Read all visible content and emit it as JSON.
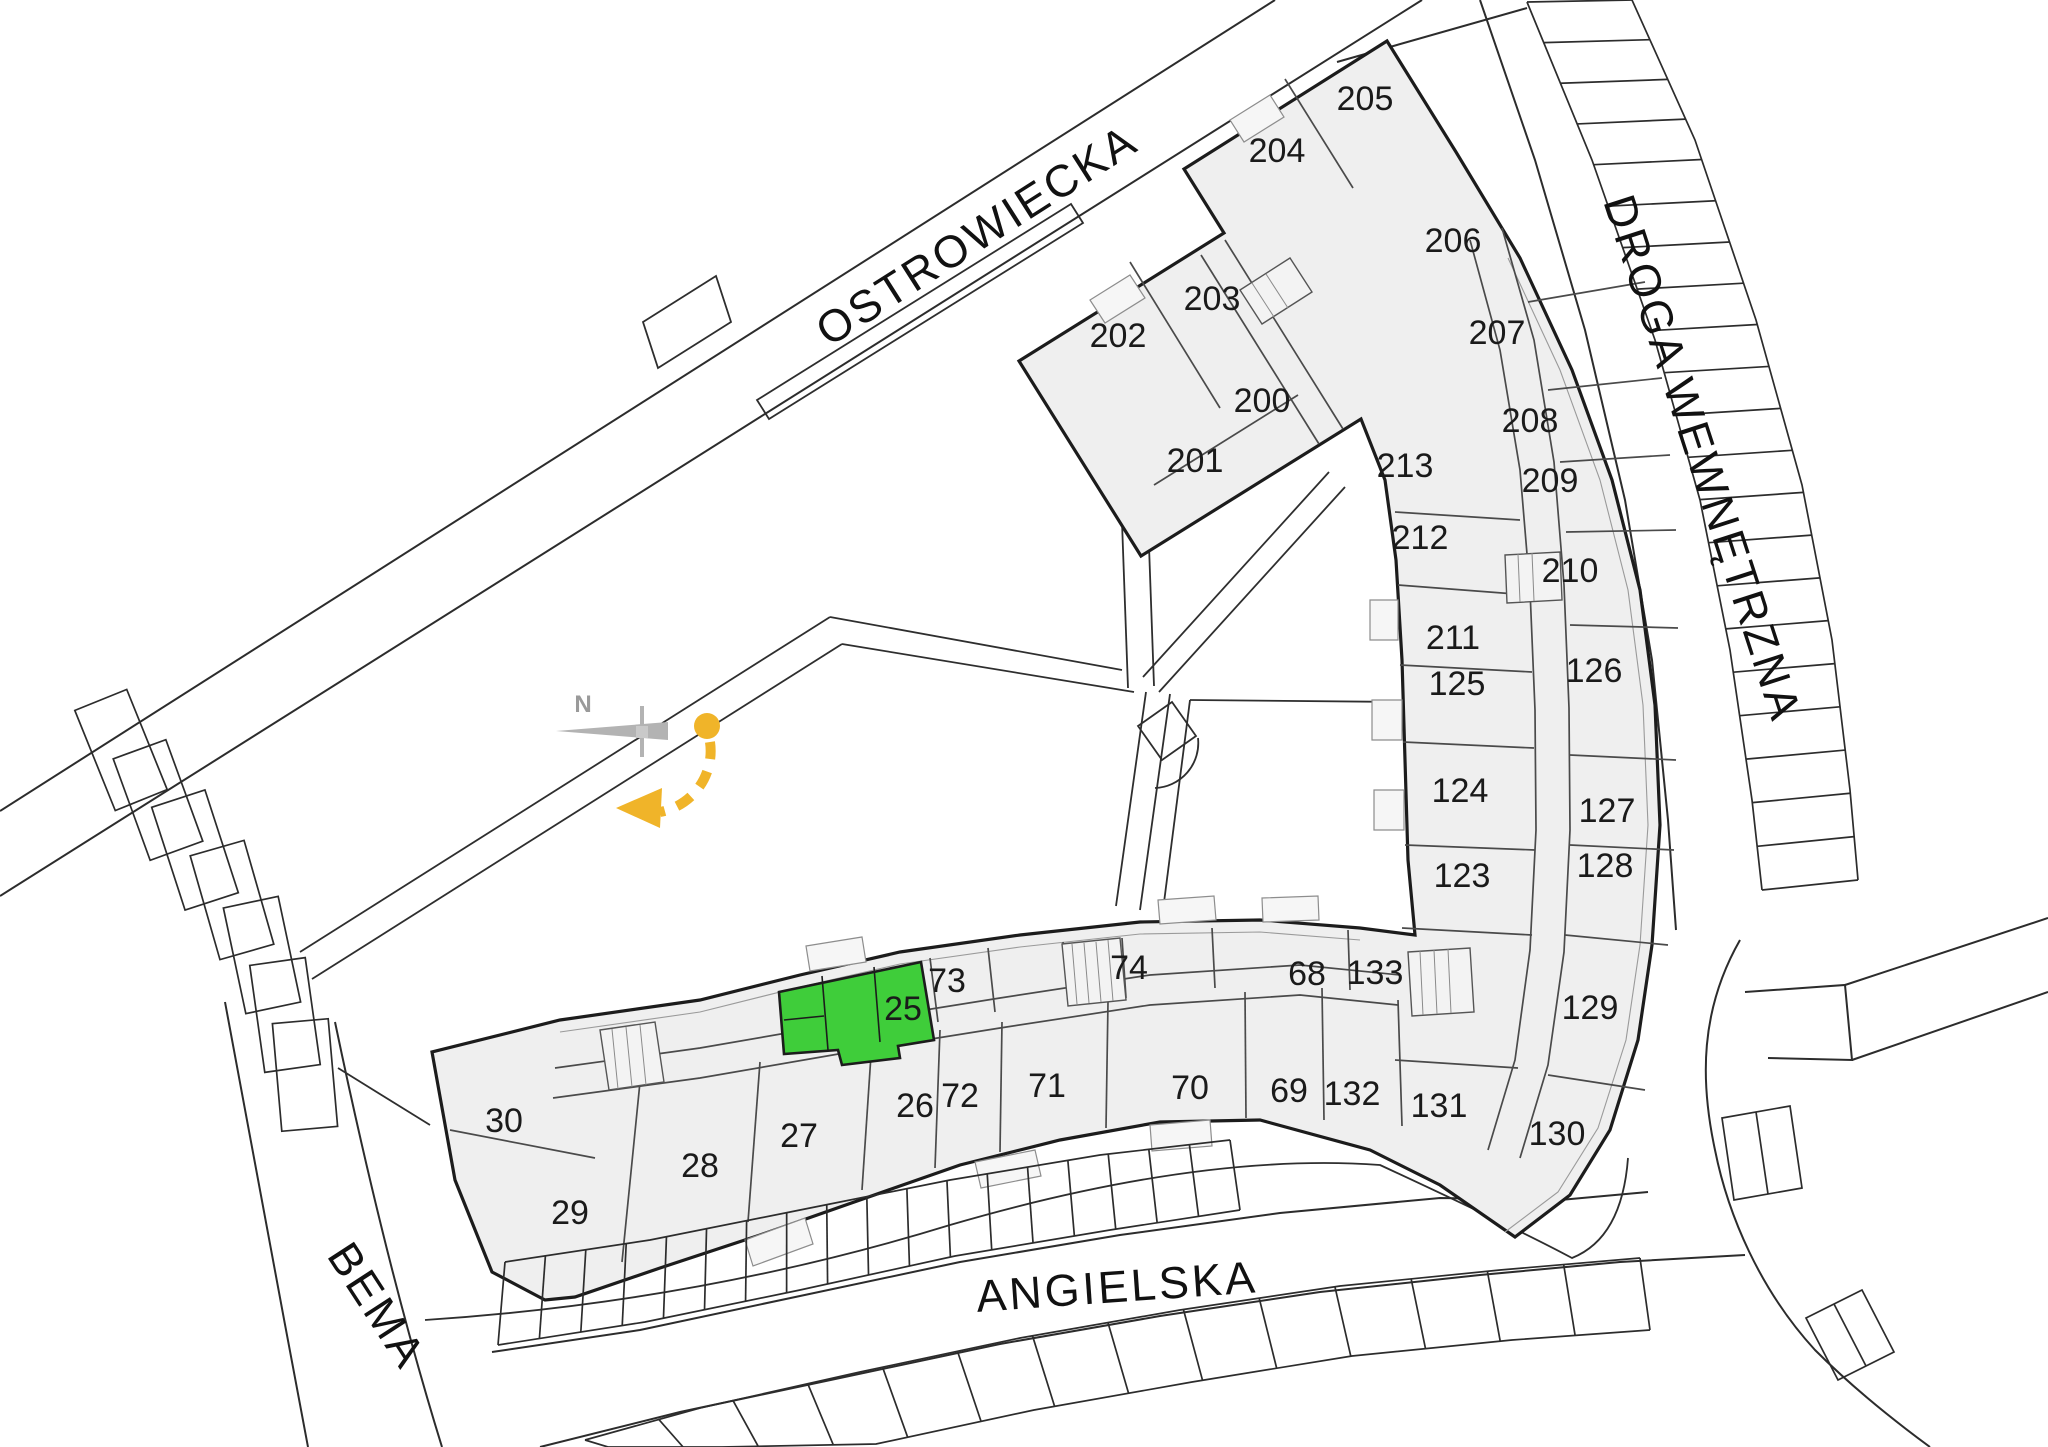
{
  "plan": {
    "compass": {
      "label": "N"
    },
    "colors": {
      "highlight_green": "#3fcd3a",
      "compass_yellow": "#f0b429",
      "building_fill": "#efefef",
      "line_dark": "#1c1c1c"
    },
    "selected_unit": {
      "label": "25",
      "x": 903,
      "y": 1020
    },
    "streets": [
      {
        "id": "ostrowiecka",
        "name": "OSTROWIECKA",
        "x": 985,
        "y": 248,
        "rotate": -32.5
      },
      {
        "id": "droga-wewnetrzna",
        "name": "DROGA WEWNĘTRZNA",
        "x": 1688,
        "y": 463,
        "rotate": 72
      },
      {
        "id": "bema",
        "name": "BEMA",
        "x": 364,
        "y": 1314,
        "rotate": 57
      },
      {
        "id": "angielska",
        "name": "ANGIELSKA",
        "x": 1118,
        "y": 1302,
        "rotate": -4
      }
    ],
    "units": [
      {
        "label": "200",
        "x": 1262,
        "y": 412
      },
      {
        "label": "201",
        "x": 1195,
        "y": 472
      },
      {
        "label": "202",
        "x": 1118,
        "y": 347
      },
      {
        "label": "203",
        "x": 1212,
        "y": 310
      },
      {
        "label": "204",
        "x": 1277,
        "y": 162
      },
      {
        "label": "205",
        "x": 1365,
        "y": 110
      },
      {
        "label": "206",
        "x": 1453,
        "y": 252
      },
      {
        "label": "207",
        "x": 1497,
        "y": 344
      },
      {
        "label": "208",
        "x": 1530,
        "y": 432
      },
      {
        "label": "209",
        "x": 1550,
        "y": 492
      },
      {
        "label": "210",
        "x": 1570,
        "y": 582
      },
      {
        "label": "211",
        "x": 1453,
        "y": 649
      },
      {
        "label": "212",
        "x": 1420,
        "y": 549
      },
      {
        "label": "213",
        "x": 1405,
        "y": 477
      },
      {
        "label": "123",
        "x": 1462,
        "y": 887
      },
      {
        "label": "124",
        "x": 1460,
        "y": 802
      },
      {
        "label": "125",
        "x": 1457,
        "y": 695
      },
      {
        "label": "126",
        "x": 1594,
        "y": 682
      },
      {
        "label": "127",
        "x": 1607,
        "y": 822
      },
      {
        "label": "128",
        "x": 1605,
        "y": 877
      },
      {
        "label": "129",
        "x": 1590,
        "y": 1019
      },
      {
        "label": "130",
        "x": 1557,
        "y": 1145
      },
      {
        "label": "131",
        "x": 1439,
        "y": 1117
      },
      {
        "label": "132",
        "x": 1352,
        "y": 1105
      },
      {
        "label": "133",
        "x": 1375,
        "y": 984
      },
      {
        "label": "26",
        "x": 915,
        "y": 1117
      },
      {
        "label": "27",
        "x": 799,
        "y": 1147
      },
      {
        "label": "28",
        "x": 700,
        "y": 1177
      },
      {
        "label": "29",
        "x": 570,
        "y": 1224
      },
      {
        "label": "30",
        "x": 504,
        "y": 1132
      },
      {
        "label": "68",
        "x": 1307,
        "y": 985
      },
      {
        "label": "69",
        "x": 1289,
        "y": 1102
      },
      {
        "label": "70",
        "x": 1190,
        "y": 1099
      },
      {
        "label": "71",
        "x": 1047,
        "y": 1097
      },
      {
        "label": "72",
        "x": 960,
        "y": 1107
      },
      {
        "label": "73",
        "x": 947,
        "y": 992
      },
      {
        "label": "74",
        "x": 1129,
        "y": 979
      }
    ]
  }
}
